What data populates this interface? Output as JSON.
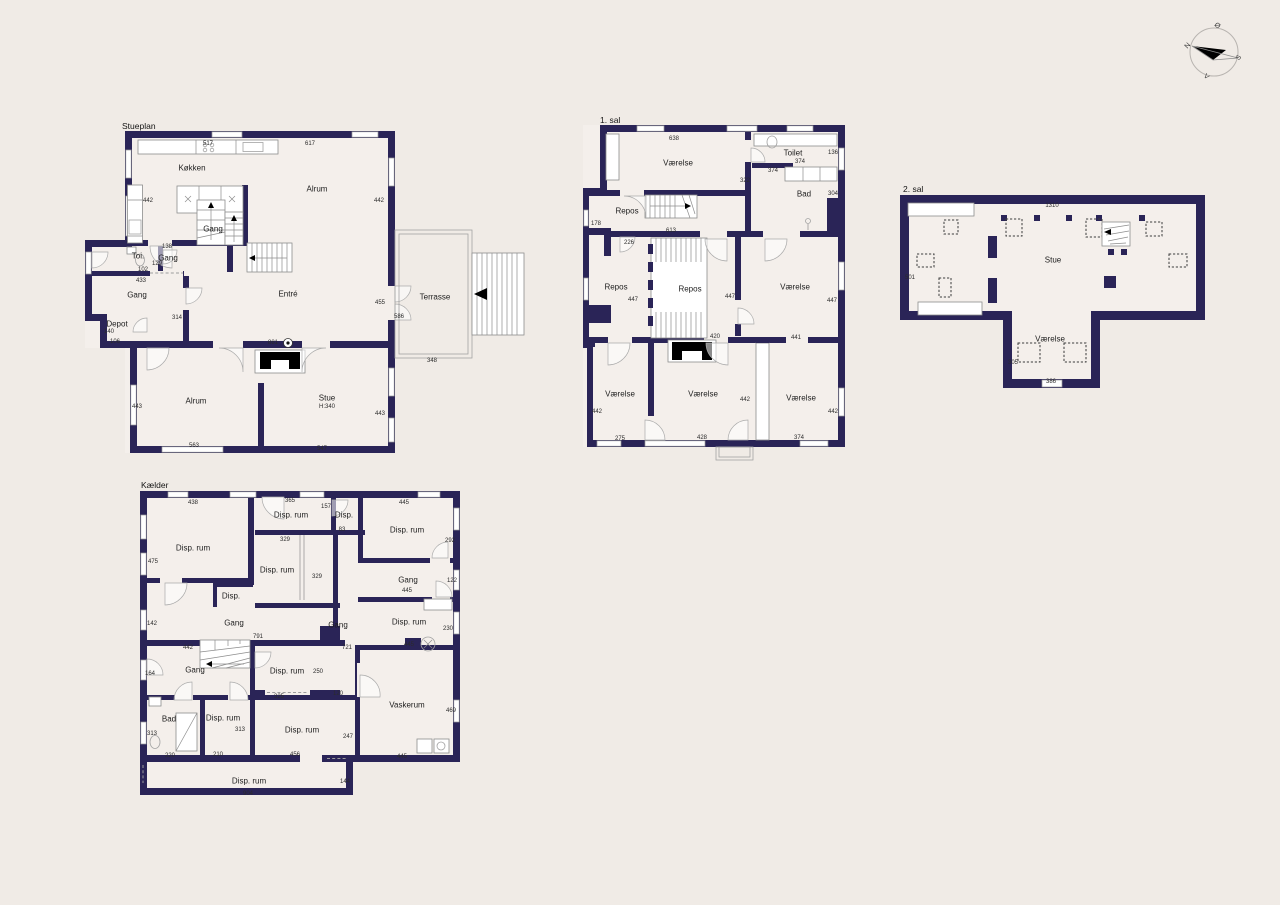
{
  "colors": {
    "wall": "#2a2457",
    "background": "#f0ebe6",
    "interior": "#f4efeb",
    "outline": "#9b9b9b",
    "text": "#1d1d1d"
  },
  "compass": {
    "east": "Ø",
    "north": "N",
    "south": "S",
    "west": "V"
  },
  "plans": {
    "stueplan": {
      "title": "Stueplan",
      "title_pos": {
        "x": 122,
        "y": 126
      },
      "rooms": [
        {
          "label": "Køkken",
          "x": 192,
          "y": 168
        },
        {
          "label": "Alrum",
          "x": 317,
          "y": 189
        },
        {
          "label": "Gang",
          "x": 213,
          "y": 229
        },
        {
          "label": "Gang",
          "x": 168,
          "y": 258
        },
        {
          "label": "Toi.",
          "x": 138,
          "y": 256
        },
        {
          "label": "Gang",
          "x": 137,
          "y": 295
        },
        {
          "label": "Depot",
          "x": 117,
          "y": 324
        },
        {
          "label": "Entré",
          "x": 288,
          "y": 294
        },
        {
          "label": "Terrasse",
          "x": 435,
          "y": 297
        },
        {
          "label": "Alrum",
          "x": 196,
          "y": 401
        },
        {
          "label": "Stue",
          "x": 327,
          "y": 398
        }
      ],
      "dims": [
        {
          "label": "517",
          "x": 208,
          "y": 144
        },
        {
          "label": "617",
          "x": 310,
          "y": 144
        },
        {
          "label": "442",
          "x": 148,
          "y": 201
        },
        {
          "label": "442",
          "x": 379,
          "y": 201
        },
        {
          "label": "138",
          "x": 167,
          "y": 247
        },
        {
          "label": "129",
          "x": 157,
          "y": 264
        },
        {
          "label": "102",
          "x": 143,
          "y": 270
        },
        {
          "label": "433",
          "x": 141,
          "y": 281
        },
        {
          "label": "314",
          "x": 177,
          "y": 318
        },
        {
          "label": "140",
          "x": 109,
          "y": 332
        },
        {
          "label": "106",
          "x": 115,
          "y": 342
        },
        {
          "label": "881",
          "x": 273,
          "y": 343
        },
        {
          "label": "455",
          "x": 380,
          "y": 303
        },
        {
          "label": "586",
          "x": 399,
          "y": 317
        },
        {
          "label": "348",
          "x": 432,
          "y": 361
        },
        {
          "label": "443",
          "x": 137,
          "y": 407
        },
        {
          "label": "443",
          "x": 380,
          "y": 414
        },
        {
          "label": "563",
          "x": 194,
          "y": 446
        },
        {
          "label": "547",
          "x": 322,
          "y": 449
        },
        {
          "label": "H:340",
          "x": 327,
          "y": 407
        }
      ]
    },
    "first_floor": {
      "title": "1. sal",
      "title_pos": {
        "x": 600,
        "y": 120
      },
      "rooms": [
        {
          "label": "Værelse",
          "x": 678,
          "y": 163
        },
        {
          "label": "Toilet",
          "x": 793,
          "y": 153
        },
        {
          "label": "Bad",
          "x": 804,
          "y": 194
        },
        {
          "label": "Repos",
          "x": 627,
          "y": 211
        },
        {
          "label": "Repos",
          "x": 616,
          "y": 287
        },
        {
          "label": "Repos",
          "x": 690,
          "y": 289
        },
        {
          "label": "Værelse",
          "x": 795,
          "y": 287
        },
        {
          "label": "Værelse",
          "x": 620,
          "y": 394
        },
        {
          "label": "Værelse",
          "x": 703,
          "y": 394
        },
        {
          "label": "Værelse",
          "x": 801,
          "y": 398
        }
      ],
      "dims": [
        {
          "label": "638",
          "x": 674,
          "y": 139
        },
        {
          "label": "374",
          "x": 800,
          "y": 162
        },
        {
          "label": "136",
          "x": 833,
          "y": 153
        },
        {
          "label": "374",
          "x": 773,
          "y": 171
        },
        {
          "label": "304",
          "x": 833,
          "y": 194
        },
        {
          "label": "322",
          "x": 745,
          "y": 181
        },
        {
          "label": "178",
          "x": 596,
          "y": 224
        },
        {
          "label": "226",
          "x": 629,
          "y": 243
        },
        {
          "label": "613",
          "x": 671,
          "y": 231
        },
        {
          "label": "447",
          "x": 633,
          "y": 300
        },
        {
          "label": "447",
          "x": 730,
          "y": 297
        },
        {
          "label": "447",
          "x": 832,
          "y": 301
        },
        {
          "label": "420",
          "x": 715,
          "y": 337
        },
        {
          "label": "441",
          "x": 796,
          "y": 338
        },
        {
          "label": "442",
          "x": 597,
          "y": 412
        },
        {
          "label": "275",
          "x": 620,
          "y": 439
        },
        {
          "label": "428",
          "x": 702,
          "y": 438
        },
        {
          "label": "442",
          "x": 745,
          "y": 400
        },
        {
          "label": "442",
          "x": 833,
          "y": 412
        },
        {
          "label": "374",
          "x": 799,
          "y": 438
        }
      ]
    },
    "second_floor": {
      "title": "2. sal",
      "title_pos": {
        "x": 903,
        "y": 189
      },
      "rooms": [
        {
          "label": "Stue",
          "x": 1053,
          "y": 260
        },
        {
          "label": "Værelse",
          "x": 1050,
          "y": 339
        }
      ],
      "dims": [
        {
          "label": "1310",
          "x": 1052,
          "y": 206
        },
        {
          "label": "501",
          "x": 910,
          "y": 278
        },
        {
          "label": "305",
          "x": 1013,
          "y": 363
        },
        {
          "label": "386",
          "x": 1051,
          "y": 382
        }
      ]
    },
    "basement": {
      "title": "Kælder",
      "title_pos": {
        "x": 141,
        "y": 485
      },
      "rooms": [
        {
          "label": "Disp. rum",
          "x": 193,
          "y": 548
        },
        {
          "label": "Disp. rum",
          "x": 291,
          "y": 515
        },
        {
          "label": "Disp.",
          "x": 344,
          "y": 515
        },
        {
          "label": "Disp. rum",
          "x": 407,
          "y": 530
        },
        {
          "label": "Disp. rum",
          "x": 277,
          "y": 570
        },
        {
          "label": "Disp.",
          "x": 231,
          "y": 596
        },
        {
          "label": "Gang",
          "x": 408,
          "y": 580
        },
        {
          "label": "Gang",
          "x": 234,
          "y": 623
        },
        {
          "label": "Gang",
          "x": 338,
          "y": 625
        },
        {
          "label": "Disp. rum",
          "x": 409,
          "y": 622
        },
        {
          "label": "Gang",
          "x": 195,
          "y": 670
        },
        {
          "label": "Disp. rum",
          "x": 287,
          "y": 671
        },
        {
          "label": "Vaskerum",
          "x": 407,
          "y": 705
        },
        {
          "label": "Bad",
          "x": 169,
          "y": 719
        },
        {
          "label": "Disp. rum",
          "x": 223,
          "y": 718
        },
        {
          "label": "Disp. rum",
          "x": 302,
          "y": 730
        },
        {
          "label": "Disp. rum",
          "x": 249,
          "y": 781
        }
      ],
      "dims": [
        {
          "label": "438",
          "x": 193,
          "y": 503
        },
        {
          "label": "365",
          "x": 290,
          "y": 501
        },
        {
          "label": "157",
          "x": 326,
          "y": 507
        },
        {
          "label": "83",
          "x": 342,
          "y": 530
        },
        {
          "label": "445",
          "x": 404,
          "y": 503
        },
        {
          "label": "292",
          "x": 450,
          "y": 541
        },
        {
          "label": "475",
          "x": 153,
          "y": 562
        },
        {
          "label": "329",
          "x": 285,
          "y": 540
        },
        {
          "label": "329",
          "x": 317,
          "y": 577
        },
        {
          "label": "122",
          "x": 452,
          "y": 581
        },
        {
          "label": "445",
          "x": 407,
          "y": 591
        },
        {
          "label": "142",
          "x": 152,
          "y": 624
        },
        {
          "label": "791",
          "x": 258,
          "y": 637
        },
        {
          "label": "230",
          "x": 448,
          "y": 629
        },
        {
          "label": "445",
          "x": 409,
          "y": 645
        },
        {
          "label": "442",
          "x": 188,
          "y": 648
        },
        {
          "label": "721",
          "x": 347,
          "y": 648
        },
        {
          "label": "164",
          "x": 150,
          "y": 674
        },
        {
          "label": "250",
          "x": 318,
          "y": 672
        },
        {
          "label": "325",
          "x": 279,
          "y": 697
        },
        {
          "label": "120",
          "x": 338,
          "y": 694
        },
        {
          "label": "469",
          "x": 451,
          "y": 711
        },
        {
          "label": "313",
          "x": 152,
          "y": 734
        },
        {
          "label": "220",
          "x": 170,
          "y": 756
        },
        {
          "label": "313",
          "x": 240,
          "y": 730
        },
        {
          "label": "210",
          "x": 218,
          "y": 755
        },
        {
          "label": "456",
          "x": 295,
          "y": 755
        },
        {
          "label": "247",
          "x": 348,
          "y": 737
        },
        {
          "label": "445",
          "x": 402,
          "y": 757
        },
        {
          "label": "144",
          "x": 345,
          "y": 782
        },
        {
          "label": "904",
          "x": 248,
          "y": 794
        }
      ]
    }
  }
}
